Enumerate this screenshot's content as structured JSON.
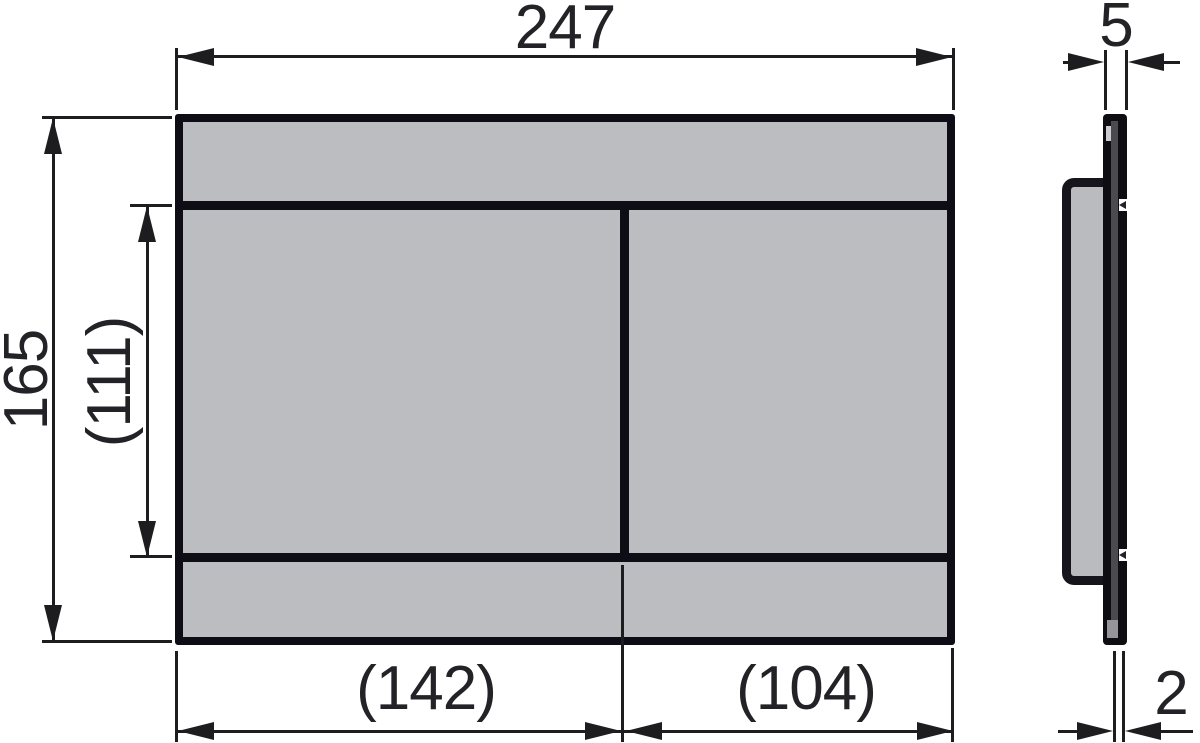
{
  "front_view": {
    "total_width": "247",
    "total_height": "165",
    "buttons_height": "(111)",
    "left_button_width": "(142)",
    "right_button_width": "(104)"
  },
  "side_view": {
    "total_depth": "5",
    "plate_thickness": "2"
  },
  "colors": {
    "plate_fill": "#bcbdc1",
    "outline": "#0e0d15",
    "dim_line": "#1d1d20",
    "side_plate_dark": "#4b4b4f"
  }
}
